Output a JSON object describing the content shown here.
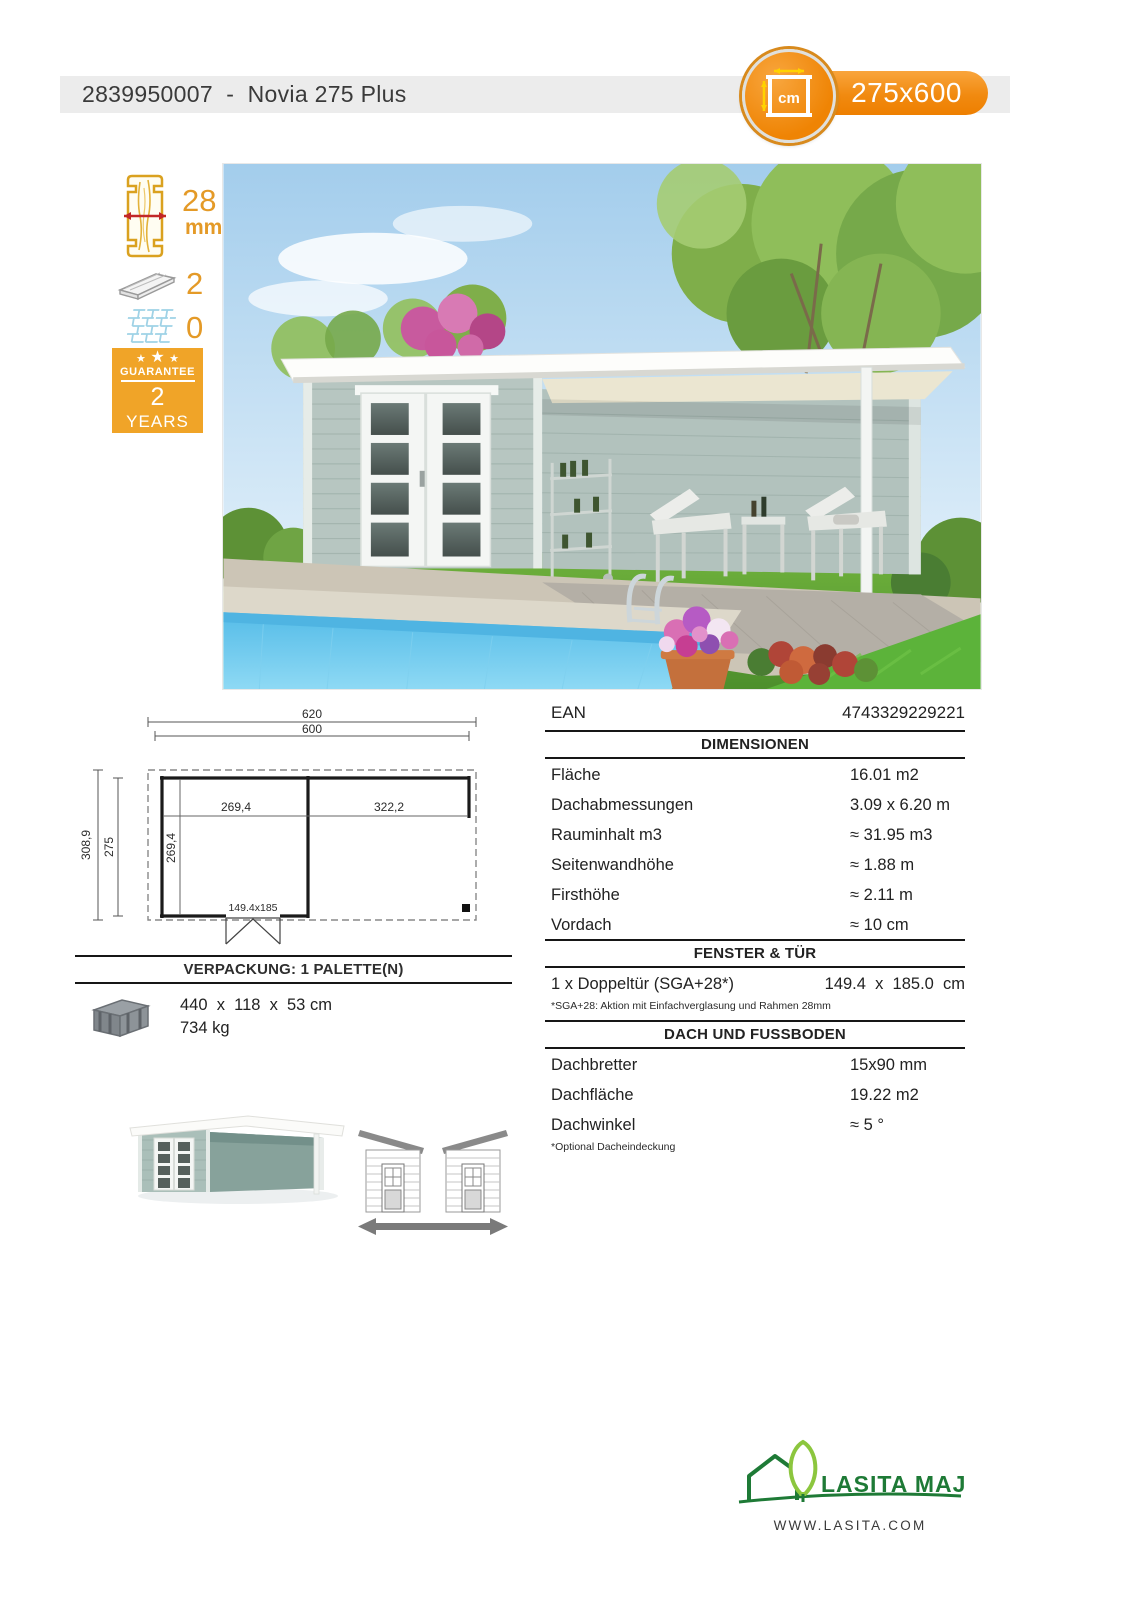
{
  "header": {
    "title": "2839950007  -  Novia 275 Plus",
    "badge": {
      "unit": "cm",
      "size": "275x600"
    }
  },
  "sidebar": {
    "wall_thickness": {
      "value": "28",
      "unit": "mm"
    },
    "roof_floor_packages": "2",
    "shingles_packages": "0",
    "guarantee": {
      "star": "★",
      "label": "GUARANTEE",
      "value": "2",
      "unit": "YEARS"
    }
  },
  "plan": {
    "total_width": "620",
    "wall_width": "600",
    "room_width": "269,4",
    "terrace_width": "322,2",
    "total_depth": "308,9",
    "wall_depth": "275",
    "room_depth": "269,4",
    "door_size": "149.4x185"
  },
  "specs": {
    "ean": {
      "label": "EAN",
      "value": "4743329229221"
    },
    "dimensions": {
      "title": "DIMENSIONEN",
      "rows": [
        {
          "label": "Fläche",
          "value": "16.01 m2"
        },
        {
          "label": "Dachabmessungen",
          "value": "3.09 x 6.20 m"
        },
        {
          "label": "Rauminhalt m3",
          "value": "≈ 31.95 m3"
        },
        {
          "label": "Seitenwandhöhe",
          "value": "≈ 1.88 m"
        },
        {
          "label": "Firsthöhe",
          "value": "≈ 2.11 m"
        },
        {
          "label": "Vordach",
          "value": "≈ 10 cm"
        }
      ]
    },
    "windows_doors": {
      "title": "FENSTER & TÜR",
      "rows": [
        {
          "label": "1 x Doppeltür (SGA+28*)",
          "value": "149.4  x  185.0  cm"
        }
      ],
      "footnote": "*SGA+28: Aktion mit Einfachverglasung und Rahmen 28mm"
    },
    "roof_floor": {
      "title": "DACH UND FUSSBODEN",
      "rows": [
        {
          "label": "Dachbretter",
          "value": "15x90 mm"
        },
        {
          "label": "Dachfläche",
          "value": "19.22 m2"
        },
        {
          "label": "Dachwinkel",
          "value": "≈ 5 °"
        }
      ],
      "footnote": "*Optional Dacheindeckung"
    }
  },
  "packaging": {
    "title": "VERPACKUNG: 1 PALETTE(N)",
    "dimensions": "440  x  118  x  53 cm",
    "weight": "734 kg"
  },
  "footer": {
    "brand": "LASITA MAJA",
    "website": "WWW.LASITA.COM"
  },
  "colors": {
    "accent_orange": "#F18A10",
    "guarantee_orange": "#F0A428",
    "logo_green": "#1E7A36",
    "logo_light_green": "#8CC63E"
  }
}
